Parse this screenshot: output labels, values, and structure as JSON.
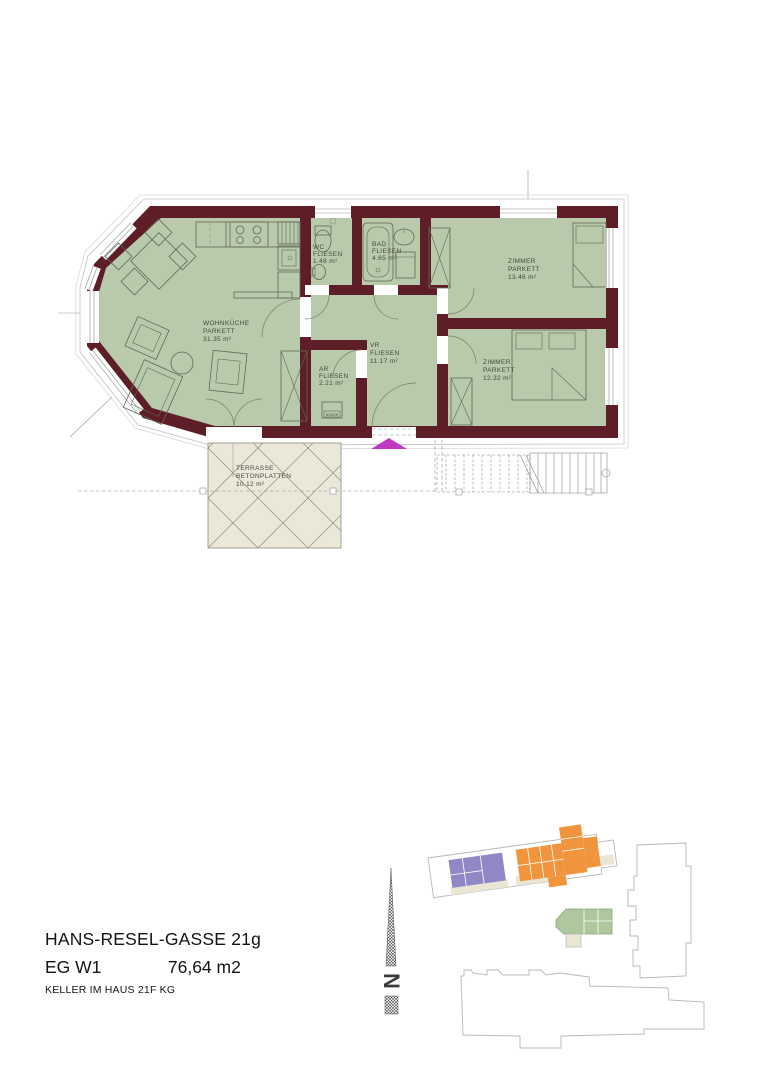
{
  "plan": {
    "rooms": [
      {
        "name": "WOHNKÜCHE",
        "floor": "PARKETT",
        "area": "31.35 m²"
      },
      {
        "name": "WC",
        "floor": "FLIESEN",
        "area": "1.48 m²"
      },
      {
        "name": "BAD",
        "floor": "FLIESEN",
        "area": "4.65 m²"
      },
      {
        "name": "ZIMMER",
        "floor": "PARKETT",
        "area": "13.46 m²"
      },
      {
        "name": "ZIMMER",
        "floor": "PARKETT",
        "area": "12.32 m²"
      },
      {
        "name": "VR",
        "floor": "FLIESEN",
        "area": "11.17 m²"
      },
      {
        "name": "AR",
        "floor": "FLIESEN",
        "area": "2.21 m²"
      }
    ],
    "terrace": {
      "name": "TERRASSE",
      "material": "BETONPLATTEN",
      "area": "10.12 m²"
    },
    "boiler_label": "BOILER",
    "colors": {
      "wall": "#5e1e28",
      "room_fill": "#b9c9ab",
      "terrace_fill": "#ebe8da",
      "entrance_marker": "#c238c2"
    }
  },
  "compass": {
    "label": "N"
  },
  "footer": {
    "address": "HANS-RESEL-GASSE 21g",
    "floor_unit": "EG  W1",
    "area": "76,64 m2",
    "cellar": "KELLER IM HAUS 21F  KG"
  },
  "site_plan": {
    "colors": {
      "highlight_unit_green": "#aec79e",
      "orange_units": "#f0943d",
      "purple_units": "#8f88c4",
      "beige_areas": "#e9e6d4",
      "outline": "#b8b8b8"
    }
  }
}
